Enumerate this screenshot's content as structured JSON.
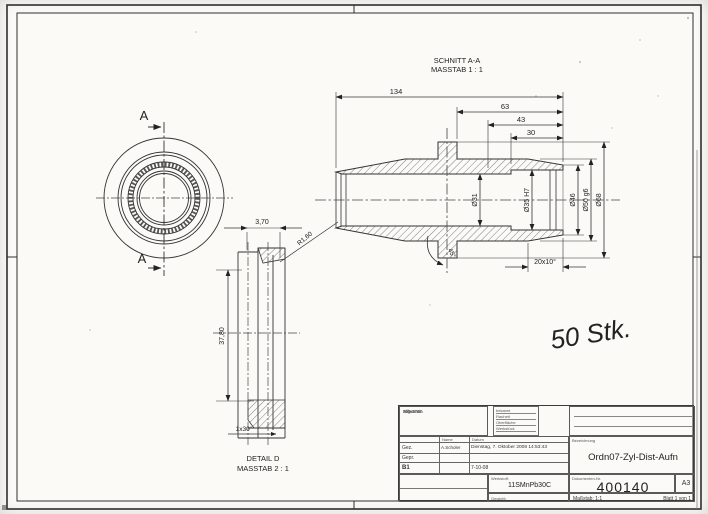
{
  "views": {
    "section_title_1": "SCHNITT A-A",
    "section_title_2": "MASSTAB 1 : 1",
    "detail_title_1": "DETAIL D",
    "detail_title_2": "MASSTAB 2 : 1",
    "cut_label_top": "A",
    "cut_label_bottom": "A"
  },
  "dims": {
    "len134": "134",
    "len63": "63",
    "len43": "43",
    "len30": "30",
    "dia31": "Ø31",
    "dia35": "Ø35 H7",
    "dia46": "Ø46",
    "dia50": "Ø50 g6",
    "dia68": "Ø68",
    "taper": "20x10°",
    "chamfer45": "45°",
    "w370": "3,70",
    "h3780": "37,80",
    "chamfer130": "1x30°",
    "radius160": "R1,60"
  },
  "annotations": {
    "quantity_note": "50 Stk."
  },
  "title_block": {
    "tolerance_lines": [
      "Allgemein",
      "Toleranz:",
      "ISO 2768"
    ],
    "field_lines": [
      "bekannt",
      "Rauheit",
      "Oberfläche",
      "Werkstück"
    ],
    "col_name": "Name",
    "col_datum": "Datum",
    "row_gez_label": "Gez.",
    "row_gez_name": "A.Scholer",
    "row_gez_date": "Dienstag, 7. Oktober 2008 14:53:43",
    "row_gepr_label": "Gepr.",
    "row_b1": "B1",
    "row_b1_date": "7-10-08",
    "material_label": "Werkstoff:",
    "material": "11SMnPb30C",
    "weight_label": "Gewicht:",
    "title_label": "Bezeichnung",
    "title": "Ordn07-Zyl-Dist-Aufn",
    "docno_label": "Dokumenten-Nr.",
    "doc_number": "400140",
    "format": "A3",
    "scale": "Maßstab: 1:1",
    "sheet": "Blatt 1 von 1"
  }
}
